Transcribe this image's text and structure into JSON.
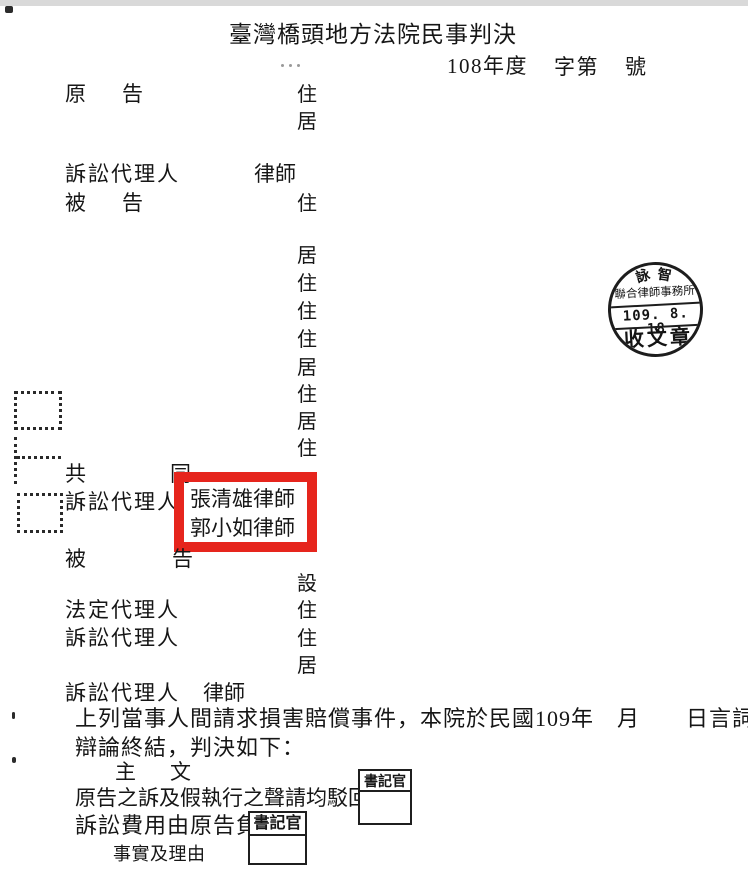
{
  "document": {
    "court_title": "臺灣橋頭地方法院民事判決",
    "case_number": {
      "year": "108年度",
      "zi_di": "字第",
      "hao": "號"
    },
    "field_labels": {
      "plaintiff_first": "原",
      "plaintiff_second": "告",
      "defendant_first": "被",
      "defendant_second": "告",
      "litigation_agent": "訴訟代理人",
      "statutory_agent": "法定代理人",
      "joint_first": "共",
      "joint_second": "同",
      "lawyer_suffix": "律師",
      "residence_zhu": "住",
      "residence_ju": "居",
      "office_she": "設"
    },
    "highlighted_lawyers": {
      "line1": "張清雄律師",
      "line2": "郭小如律師"
    },
    "body": {
      "paragraph_line1": "上列當事人間請求損害賠償事件，本院於民國109年　月　　日言詞",
      "paragraph_line2": "辯論終結，判決如下：",
      "main_text_char1": "主",
      "main_text_char2": "文",
      "ruling_line1": "原告之訴及假執行之聲請均駁回",
      "ruling_line2": "訴訟費用由原告負擔",
      "facts_heading": "事實及理由"
    }
  },
  "stamps": {
    "receipt_stamp": {
      "firm_top_1": "詠",
      "firm_top_2": "智",
      "firm_bottom": "聯合律師事務所",
      "date": "109. 8. 18",
      "label": "收文章"
    },
    "clerk_stamp": {
      "label": "書記官"
    }
  },
  "colors": {
    "highlight_red": "#e6251d",
    "ink": "#1a1a1a"
  }
}
